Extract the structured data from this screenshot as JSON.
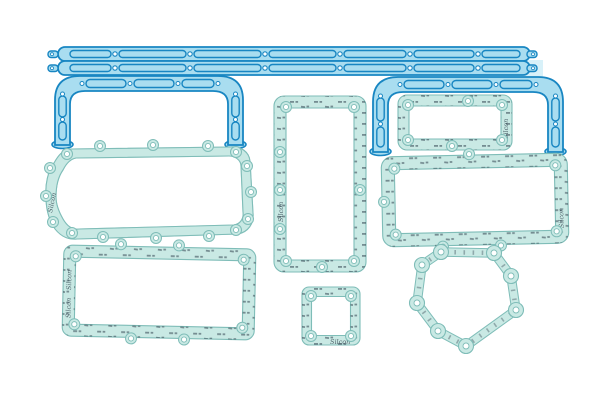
{
  "image": {
    "type": "product-photo",
    "subject": "Automotive engine gasket seal kit laid out flat on a white background",
    "piece_count": 11
  },
  "watermark": {
    "text": "Silcon",
    "description": "tiny brand print repeated along the paper gasket bands"
  },
  "palette": {
    "background": "#ffffff",
    "silicone_fill": "#a9ddf0",
    "silicone_outline": "#1886c2",
    "silicone_web": "#d8f1f9",
    "paper_fill": "#c9e9e4",
    "paper_edge": "#7fbdb8",
    "print_mark": "#31424e",
    "hole": "#ffffff"
  },
  "parts": {
    "silicone": [
      {
        "name": "rail-seal-upper",
        "description": "long segmented silicone rail seal with end tabs"
      },
      {
        "name": "rail-seal-lower",
        "description": "long segmented silicone rail seal with end tabs"
      },
      {
        "name": "arch-seal-left",
        "description": "arched silicone seal with two flared legs"
      },
      {
        "name": "arch-seal-right",
        "description": "arched silicone seal with two flared legs"
      }
    ],
    "paper": [
      {
        "name": "oil-pan-gasket",
        "shape": "elongated oval frame with bolt-hole tabs"
      },
      {
        "name": "tall-side-cover-gasket",
        "shape": "tall rectangular frame"
      },
      {
        "name": "small-top-cover-gasket",
        "shape": "wide rectangular frame"
      },
      {
        "name": "large-cover-gasket",
        "shape": "large rectangular frame"
      },
      {
        "name": "bottom-left-cover-gasket",
        "shape": "rectangular frame"
      },
      {
        "name": "small-square-gasket",
        "shape": "small square frame with four corner holes"
      },
      {
        "name": "polygon-cover-gasket",
        "shape": "irregular polygon ring with bolt bosses"
      }
    ]
  }
}
